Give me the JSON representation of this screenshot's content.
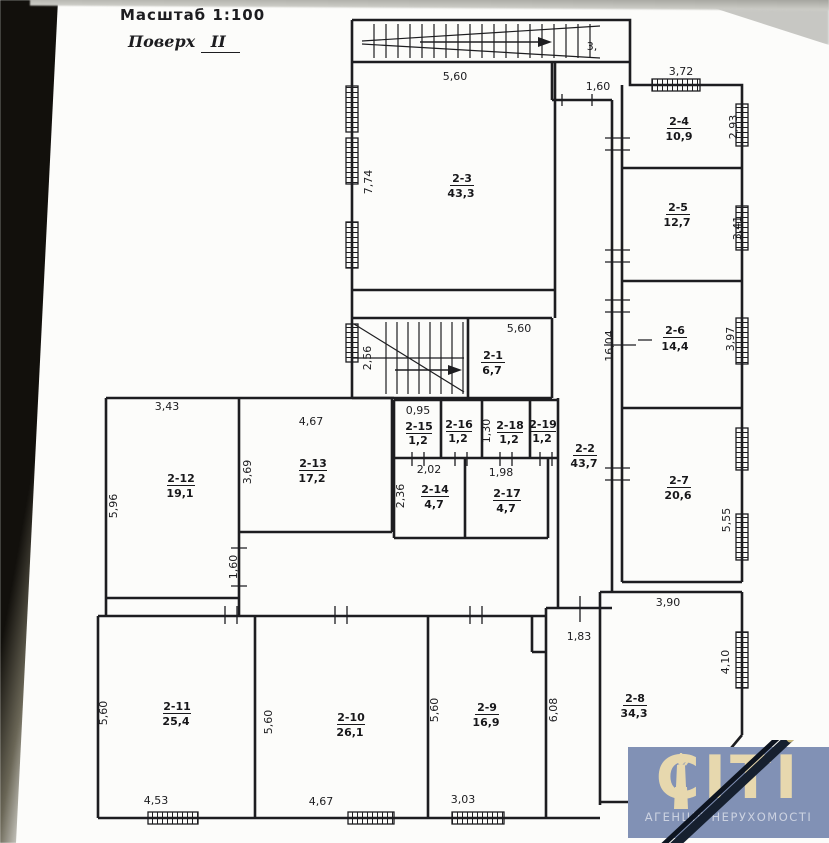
{
  "header": {
    "scale_label": "Масштаб 1:100",
    "floor_prefix": "Поверх",
    "floor_number": "II"
  },
  "plan": {
    "rooms": [
      {
        "id": "2-1",
        "area": "6,7"
      },
      {
        "id": "2-2",
        "area": "43,7"
      },
      {
        "id": "2-3",
        "area": "43,3"
      },
      {
        "id": "2-4",
        "area": "10,9"
      },
      {
        "id": "2-5",
        "area": "12,7"
      },
      {
        "id": "2-6",
        "area": "14,4"
      },
      {
        "id": "2-7",
        "area": "20,6"
      },
      {
        "id": "2-8",
        "area": "34,3"
      },
      {
        "id": "2-9",
        "area": "16,9"
      },
      {
        "id": "2-10",
        "area": "26,1"
      },
      {
        "id": "2-11",
        "area": "25,4"
      },
      {
        "id": "2-12",
        "area": "19,1"
      },
      {
        "id": "2-13",
        "area": "17,2"
      },
      {
        "id": "2-14",
        "area": "4,7"
      },
      {
        "id": "2-15",
        "area": "1,2"
      },
      {
        "id": "2-16",
        "area": "1,2"
      },
      {
        "id": "2-17",
        "area": "4,7"
      },
      {
        "id": "2-18",
        "area": "1,2"
      },
      {
        "id": "2-19",
        "area": "1,2"
      }
    ],
    "dims": {
      "r3_top": "5,60",
      "r3_left": "7,74",
      "passage_top": "3,",
      "passage_width": "1,60",
      "r4_top": "3,72",
      "r4_right": "2,93",
      "r5_right": "3,41",
      "r6_right": "3,97",
      "corridor_height": "16,04",
      "stair_left": "2,56",
      "stair_top": "5,60",
      "r15_top": "0,95",
      "r18_left": "1,30",
      "r14_top": "2,02",
      "r14_left": "2,36",
      "r17_top": "1,98",
      "r12_top": "3,43",
      "r12_left": "5,96",
      "r13_top": "4,67",
      "r13_left": "3,69",
      "r7_right": "5,55",
      "hall_door": "1,60",
      "r8_top": "3,90",
      "r8_step": "1,83",
      "r8_right": "4,10",
      "corridor_right": "6,08",
      "r11_left": "5,60",
      "r11_bottom": "4,53",
      "r10_left": "5,60",
      "r10_bottom": "4,67",
      "r9_left": "5,60",
      "r9_bottom": "3,03"
    }
  },
  "watermark": {
    "brand": "СІТІ",
    "tagline": "АГЕНЦІЯ НЕРУХОМОСТІ",
    "bg_color": "#8191b5",
    "brand_color": "#e7d8ae"
  }
}
